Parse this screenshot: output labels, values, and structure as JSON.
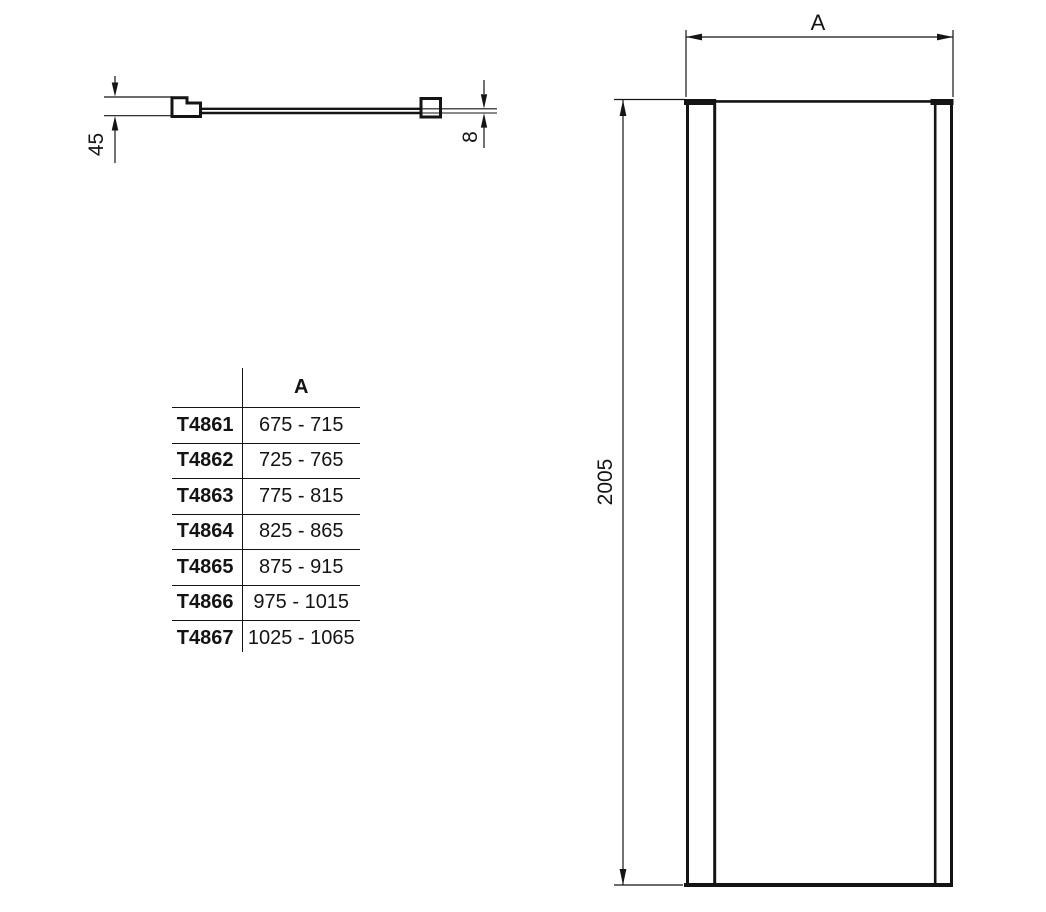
{
  "page": {
    "background_color": "#ffffff",
    "line_color": "#141414"
  },
  "plan_view": {
    "depth_dim": "45",
    "thickness_dim": "8"
  },
  "front_view": {
    "width_dim": "A",
    "height_dim": "2005"
  },
  "size_table": {
    "column_header": "A",
    "rows": [
      {
        "model": "T4861",
        "range": "675 - 715"
      },
      {
        "model": "T4862",
        "range": "725 - 765"
      },
      {
        "model": "T4863",
        "range": "775 - 815"
      },
      {
        "model": "T4864",
        "range": "825 - 865"
      },
      {
        "model": "T4865",
        "range": "875 - 915"
      },
      {
        "model": "T4866",
        "range": "975 - 1015"
      },
      {
        "model": "T4867",
        "range": "1025 - 1065"
      }
    ]
  }
}
